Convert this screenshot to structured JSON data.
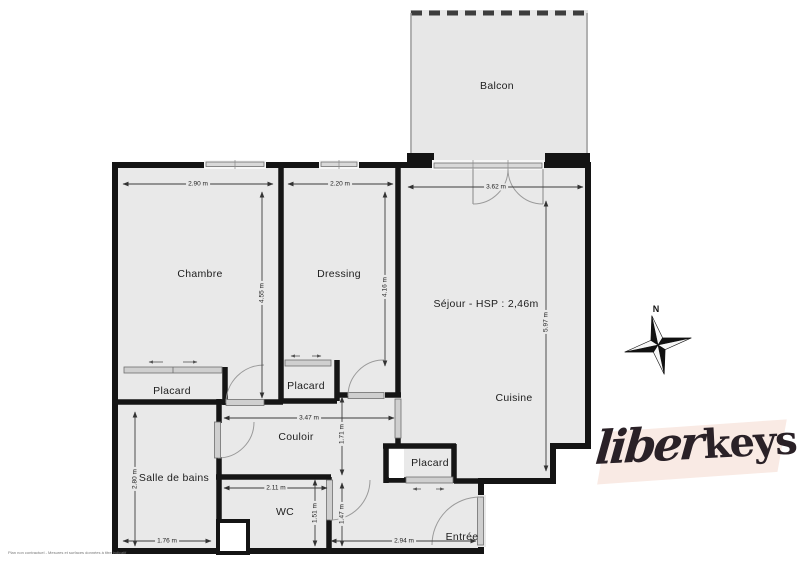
{
  "rooms": {
    "balcon": "Balcon",
    "chambre": "Chambre",
    "dressing": "Dressing",
    "sejour": "Séjour - HSP : 2,46m",
    "cuisine": "Cuisine",
    "couloir": "Couloir",
    "salle_de_bains": "Salle de bains",
    "wc": "WC",
    "entree": "Entrée",
    "placard_chambre": "Placard",
    "placard_dressing": "Placard",
    "placard_entree": "Placard"
  },
  "dimensions": {
    "chambre_width": "2.90 m",
    "chambre_depth": "4.55 m",
    "dressing_width": "2.20 m",
    "dressing_depth": "4.16 m",
    "sejour_width": "3.62 m",
    "sejour_depth": "5.97 m",
    "couloir_length": "3.47 m",
    "couloir_width": "1.71 m",
    "sdb_depth": "2.80 m",
    "sdb_width": "1.76 m",
    "wc_width": "2.11 m",
    "wc_depth": "1.51 m",
    "entree_depth": "1.47 m",
    "entree_width": "2.94 m"
  },
  "compass": {
    "north_label": "N"
  },
  "logo": {
    "script_part": "liber",
    "bold_part": "keys"
  },
  "footer": {
    "disclaimer": "Plan non contractuel - Mesures et surfaces données à titre indicatif"
  },
  "colors": {
    "floor": "#e9e9e9",
    "wall": "#141414",
    "balcony_floor": "#e7e7e7",
    "logo_background": "#f9eae4",
    "logo_text": "#2a2127"
  }
}
